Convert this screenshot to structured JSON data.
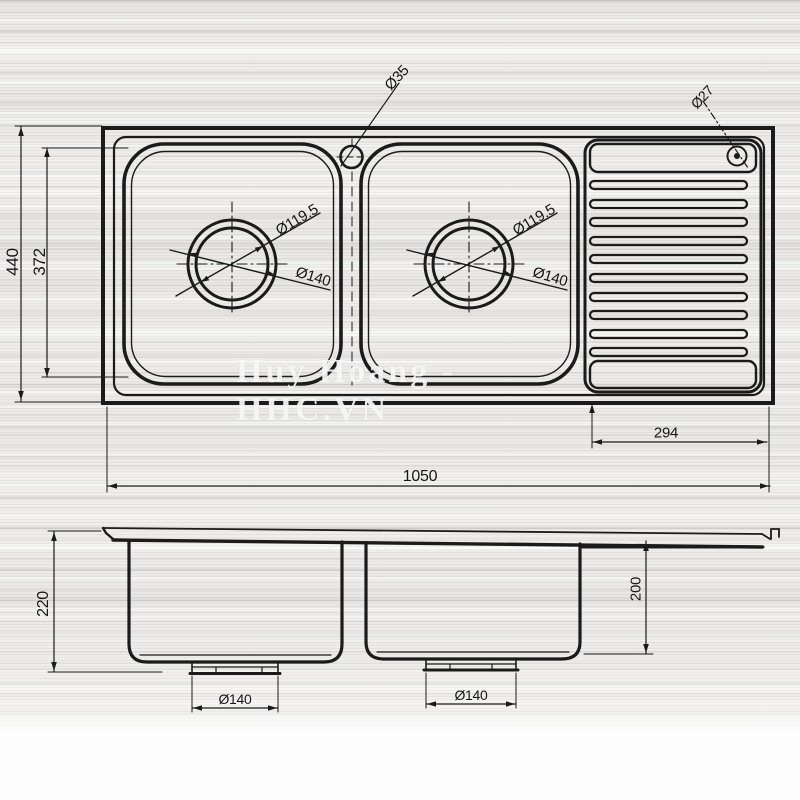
{
  "watermark": "Huy Hoang - HHC.VN",
  "top_view": {
    "overall_width": "1050",
    "overall_depth": "440",
    "basin_depth": "372",
    "drainboard_width": "294",
    "faucet_hole_dia": "Ø35",
    "overflow_hole_dia": "Ø27",
    "bowl1": {
      "drain_inner_dia": "Ø119.5",
      "drain_outer_dia": "Ø140"
    },
    "bowl2": {
      "drain_inner_dia": "Ø119.5",
      "drain_outer_dia": "Ø140"
    }
  },
  "front_view": {
    "overall_height": "220",
    "bowl_depth": "200",
    "bowl1_drain_dia": "Ø140",
    "bowl2_drain_dia": "Ø140"
  },
  "colors": {
    "line": "#1b1b1b",
    "background": "#eeedeb"
  }
}
